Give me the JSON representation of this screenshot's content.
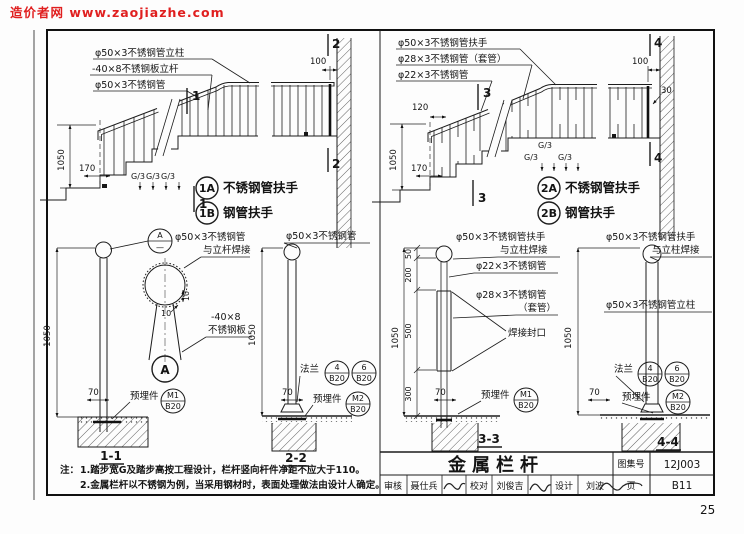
{
  "wm": {
    "text": "造价者网 www.zaojiazhe.com"
  },
  "specs": {
    "post50": "φ50×3不锈钢管立柱",
    "plate40": "-40×8不锈钢板立杆",
    "pipe50": "φ50×3不锈钢管",
    "rail50": "φ50×3不锈钢管扶手",
    "sleeve28": "φ28×3不锈钢管（套管）",
    "pipe22": "φ22×3不锈钢管",
    "pipe28": "φ28×3不锈钢管",
    "sleeve_sub": "（套管）",
    "weld_post": "与立杆焊接",
    "weld_column": "与立柱焊接",
    "weld_seal": "焊接封口",
    "plate1": "-40×8",
    "plate2": "不锈钢板",
    "flange": "法兰",
    "embed": "预埋件"
  },
  "dims": {
    "h1050": "1050",
    "d170": "170",
    "d100": "100",
    "d120": "120",
    "d30": "30",
    "d70": "70",
    "d10": "10",
    "g3": "G/3",
    "s50": "50",
    "s200": "200",
    "s500": "500",
    "s300": "300"
  },
  "marks": {
    "s1": "1",
    "s2": "2",
    "s3": "3",
    "s4": "4"
  },
  "variants": {
    "t1a": "1A",
    "t1b": "1B",
    "t2a": "2A",
    "t2b": "2B",
    "stainless": "不锈钢管扶手",
    "steel": "钢管扶手"
  },
  "details": {
    "d11": "1-1",
    "d22": "2-2",
    "d33": "3-3",
    "d44": "4-4",
    "a": "A",
    "adash": "—"
  },
  "parts": {
    "m1": "M1",
    "m2": "M2",
    "b4": "4",
    "b6": "6",
    "b20": "B20"
  },
  "notes": {
    "prefix": "注：",
    "line1": "1.踏步宽G及踏步高按工程设计，栏杆竖向杆件净距不应大于110。",
    "line2": "2.金属栏杆以不锈钢为例，当采用钢材时，表面处理做法由设计人确定。"
  },
  "tb": {
    "title": "金属栏杆",
    "atlas_label": "图集号",
    "atlas_no": "12J003",
    "page_label": "页",
    "page_no": "B11",
    "corner": "25",
    "staff": [
      {
        "role": "审核",
        "name": "聂仕兵"
      },
      {
        "role": "校对",
        "name": "刘俊吉"
      },
      {
        "role": "设计",
        "name": "刘波"
      }
    ]
  },
  "colors": {
    "watermark": "#e01f1f",
    "ink": "#1c1c1c",
    "paper": "#fdfdfd"
  }
}
